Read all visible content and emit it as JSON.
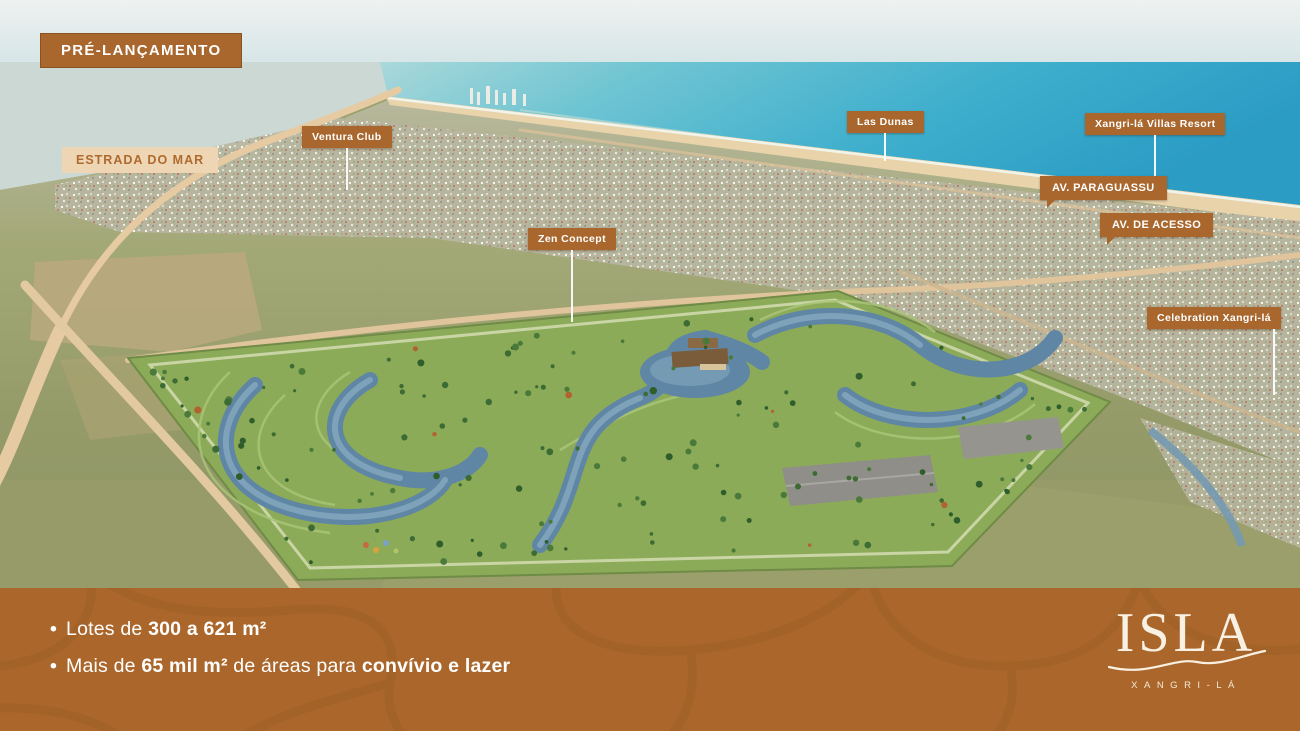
{
  "slide": {
    "pre_launch_badge": "PRÉ-LANÇAMENTO"
  },
  "map": {
    "labels": {
      "estrada_do_mar": "ESTRADA DO MAR",
      "ventura_club": "Ventura Club",
      "zen_concept": "Zen Concept",
      "las_dunas": "Las Dunas",
      "villas_resort": "Xangri-lá Villas Resort",
      "av_paraguassu": "AV. PARAGUASSU",
      "av_de_acesso": "AV. DE ACESSO",
      "celebration": "Celebration Xangri-lá"
    }
  },
  "footer": {
    "bullet_char": "•",
    "bullets": [
      {
        "prefix": "Lotes de ",
        "bold1": "300 a 621 m²",
        "mid": "",
        "bold2": ""
      },
      {
        "prefix": "Mais de ",
        "bold1": "65 mil m²",
        "mid": " de áreas para ",
        "bold2": "convívio e lazer"
      }
    ],
    "logo": {
      "wordmark": "ISLA",
      "subtitle": "XANGRI-LÁ"
    }
  },
  "colors": {
    "badge_brown": "#a9672e",
    "label_tan_bg": "#eed5b4",
    "label_tan_text": "#ae6a2f",
    "footer_bg": "#ab672b",
    "footer_pattern_line": "#9d6027",
    "ocean_deep": "#2b9cc4",
    "ocean_shallow": "#a9d8da",
    "sand": "#e8d3ab",
    "field_green": "#939a68",
    "plot_green": "#8cab58",
    "canal_blue": "#5f86a4",
    "text_white": "#ffffff"
  }
}
